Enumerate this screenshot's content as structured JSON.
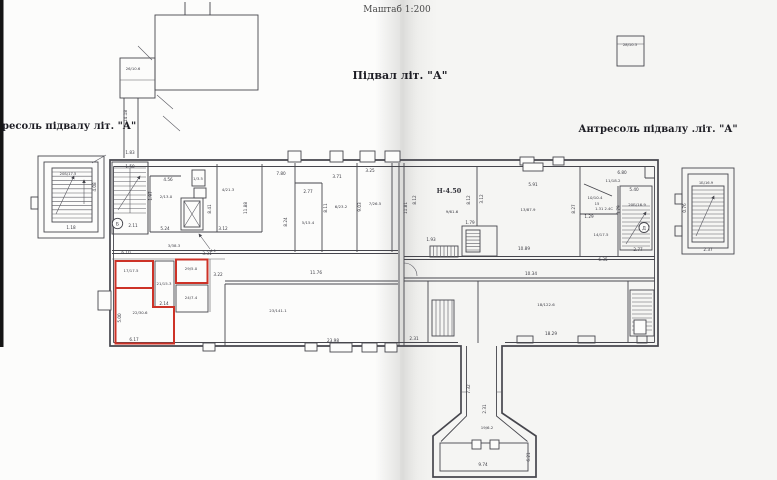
{
  "titles": {
    "scale_note": "Маштаб 1:200",
    "plan_title": "Підвал  літ. \"А\"",
    "left_mezzanine": "ресоль підвалу  літ. \"А\"",
    "right_mezzanine": "Антресоль підвалу  .літ. \"А\"",
    "height_mark": "Н-4.50"
  },
  "colors": {
    "wall": "#46464d",
    "red_outline": "#cd3227",
    "paper": "#fcfcfb",
    "scan_edge": "#151515"
  },
  "axis_markers": [
    {
      "t": "Б",
      "x": 117.5,
      "y": 225.5,
      "s": 4.6
    },
    {
      "t": "Д",
      "x": 644,
      "y": 229.5,
      "s": 4.6
    }
  ],
  "labels": [
    {
      "t": "26/10.6",
      "x": 133,
      "y": 70,
      "s": 3.8
    },
    {
      "t": "14.18",
      "x": 127,
      "y": 116,
      "r": -90
    },
    {
      "t": "1.83",
      "x": 130,
      "y": 154
    },
    {
      "t": "1.50",
      "x": 130,
      "y": 168
    },
    {
      "t": "4.56",
      "x": 168,
      "y": 181
    },
    {
      "t": "1.97",
      "x": 152,
      "y": 196,
      "r": -90
    },
    {
      "t": "2/13.0",
      "x": 166,
      "y": 198,
      "s": 3.9
    },
    {
      "t": "1/3.5",
      "x": 198,
      "y": 180,
      "s": 3.8
    },
    {
      "t": "5.24",
      "x": 165,
      "y": 230
    },
    {
      "t": "8.41",
      "x": 211,
      "y": 209,
      "r": -90
    },
    {
      "t": "4/21.3",
      "x": 228,
      "y": 191,
      "s": 3.9
    },
    {
      "t": "3.12",
      "x": 223,
      "y": 230
    },
    {
      "t": "11.88",
      "x": 247,
      "y": 208,
      "r": -90
    },
    {
      "t": "7.80",
      "x": 281,
      "y": 175
    },
    {
      "t": "2.77",
      "x": 308,
      "y": 193
    },
    {
      "t": "8.24",
      "x": 287,
      "y": 222,
      "r": -90
    },
    {
      "t": "5/15.4",
      "x": 308,
      "y": 224,
      "s": 3.9
    },
    {
      "t": "3.71",
      "x": 337,
      "y": 178
    },
    {
      "t": "8.11",
      "x": 327,
      "y": 208,
      "r": -90
    },
    {
      "t": "6/23.2",
      "x": 341,
      "y": 208,
      "s": 3.9
    },
    {
      "t": "3.25",
      "x": 370,
      "y": 172
    },
    {
      "t": "9.03",
      "x": 361,
      "y": 207,
      "r": -90
    },
    {
      "t": "7/26.5",
      "x": 375,
      "y": 205,
      "s": 3.9
    },
    {
      "t": "2.11",
      "x": 133,
      "y": 227
    },
    {
      "t": "3/38.3",
      "x": 174,
      "y": 247,
      "s": 3.9
    },
    {
      "t": "4.1",
      "x": 213,
      "y": 252,
      "s": 3.8
    },
    {
      "t": "6.10",
      "x": 126,
      "y": 254
    },
    {
      "t": "3.31",
      "x": 207,
      "y": 255
    },
    {
      "t": "3.22",
      "x": 218,
      "y": 276
    },
    {
      "t": "11.76",
      "x": 316,
      "y": 274
    },
    {
      "t": "17/17.5",
      "x": 131,
      "y": 272,
      "s": 3.9
    },
    {
      "t": "21/15.3",
      "x": 164,
      "y": 285,
      "s": 3.9
    },
    {
      "t": "29/5.0",
      "x": 191,
      "y": 270,
      "s": 3.9
    },
    {
      "t": "24/7.4",
      "x": 191,
      "y": 299,
      "s": 3.9
    },
    {
      "t": "2.14",
      "x": 164,
      "y": 305
    },
    {
      "t": "22/30.6",
      "x": 140,
      "y": 314,
      "s": 3.9
    },
    {
      "t": "5.00",
      "x": 121,
      "y": 318,
      "r": -90
    },
    {
      "t": "6.17",
      "x": 134,
      "y": 341
    },
    {
      "t": "23/141.1",
      "x": 278,
      "y": 312,
      "s": 3.9
    },
    {
      "t": "23.98",
      "x": 333,
      "y": 342
    },
    {
      "t": "11.81",
      "x": 407,
      "y": 208,
      "r": -90
    },
    {
      "t": "8.12",
      "x": 416,
      "y": 200,
      "r": -90
    },
    {
      "t": "9/61.6",
      "x": 452,
      "y": 213,
      "s": 3.9
    },
    {
      "t": "8.12",
      "x": 470,
      "y": 200,
      "r": -90
    },
    {
      "t": "1.93",
      "x": 431,
      "y": 241
    },
    {
      "t": "1.79",
      "x": 470,
      "y": 224
    },
    {
      "t": "3.12",
      "x": 483,
      "y": 199,
      "r": -90
    },
    {
      "t": "5.91",
      "x": 533,
      "y": 186
    },
    {
      "t": "13/87.9",
      "x": 528,
      "y": 211,
      "s": 3.9
    },
    {
      "t": "10.89",
      "x": 524,
      "y": 250
    },
    {
      "t": "8.27",
      "x": 575,
      "y": 209,
      "r": -90
    },
    {
      "t": "6.80",
      "x": 622,
      "y": 174
    },
    {
      "t": "11/18.2",
      "x": 613,
      "y": 182,
      "s": 3.9
    },
    {
      "t": "5.40",
      "x": 634,
      "y": 191
    },
    {
      "t": "10/10.4",
      "x": 595,
      "y": 199,
      "s": 3.9
    },
    {
      "t": "15",
      "x": 597,
      "y": 205,
      "s": 3.7
    },
    {
      "t": "1.31 2.4С",
      "x": 604,
      "y": 210,
      "s": 3.7
    },
    {
      "t": "1.29",
      "x": 589,
      "y": 218
    },
    {
      "t": "14/17.5",
      "x": 601,
      "y": 236,
      "s": 3.9
    },
    {
      "t": "20Б/16.9",
      "x": 637,
      "y": 206,
      "s": 3.9
    },
    {
      "t": "3.79",
      "x": 620,
      "y": 210,
      "r": -90
    },
    {
      "t": "2.77",
      "x": 638,
      "y": 251
    },
    {
      "t": "6.35",
      "x": 603,
      "y": 261
    },
    {
      "t": "10.34",
      "x": 531,
      "y": 275
    },
    {
      "t": "18/122.6",
      "x": 546,
      "y": 306,
      "s": 3.9
    },
    {
      "t": "18.29",
      "x": 551,
      "y": 335
    },
    {
      "t": "2.31",
      "x": 414,
      "y": 340
    },
    {
      "t": "7.32",
      "x": 470,
      "y": 389,
      "r": -90
    },
    {
      "t": "2.31",
      "x": 486,
      "y": 409,
      "r": -90
    },
    {
      "t": "19/6.2",
      "x": 487,
      "y": 429,
      "s": 3.9
    },
    {
      "t": "9.74",
      "x": 483,
      "y": 466
    },
    {
      "t": "6.21",
      "x": 530,
      "y": 457,
      "r": -90
    },
    {
      "t": "28/10.3",
      "x": 630,
      "y": 46,
      "s": 3.7
    },
    {
      "t": "20Б/17.5",
      "x": 68,
      "y": 175,
      "s": 3.7
    },
    {
      "t": "4.08",
      "x": 96,
      "y": 187,
      "r": -90
    },
    {
      "t": "1.18",
      "x": 71,
      "y": 229
    },
    {
      "t": "1Б/16.9",
      "x": 706,
      "y": 184,
      "s": 3.7
    },
    {
      "t": "2.37",
      "x": 708,
      "y": 251
    },
    {
      "t": "0.76",
      "x": 686,
      "y": 208,
      "r": -90
    }
  ]
}
